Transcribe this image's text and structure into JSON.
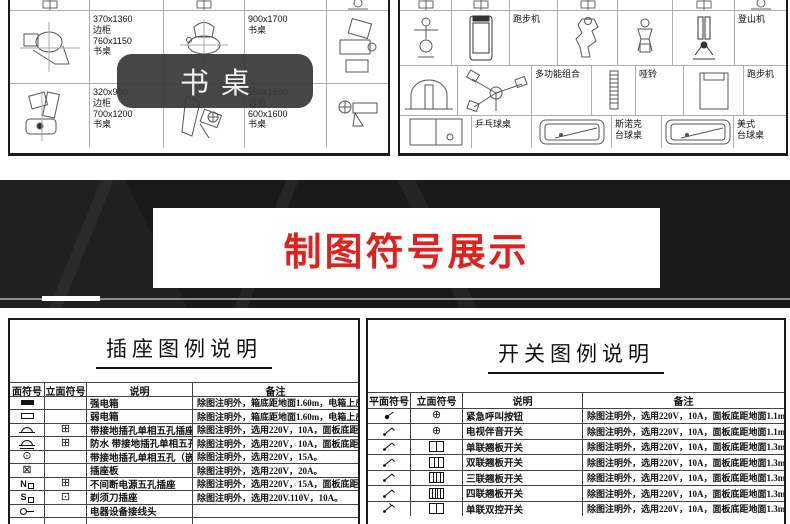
{
  "top_panels": {
    "overlay_label": "书桌",
    "left_panel": {
      "rows": [
        {
          "h": 13,
          "cells": [
            {
              "w": 80,
              "icon": "stub-line"
            },
            {
              "w": 74
            },
            {
              "w": 81,
              "icon": "stub-line"
            },
            {
              "w": 82
            },
            {
              "icon": "stub-chair"
            }
          ]
        },
        {
          "h": 73,
          "cells": [
            {
              "w": 80,
              "icon": "desk1"
            },
            {
              "w": 74,
              "label": "370x1360\n边柜\n760x1150\n书桌"
            },
            {
              "w": 81,
              "icon": "desk2"
            },
            {
              "w": 82,
              "label": "900x1700\n书桌"
            },
            {
              "icon": "desk3"
            }
          ]
        },
        {
          "h": 64,
          "cells": [
            {
              "w": 80,
              "icon": "desk4"
            },
            {
              "w": 74,
              "label": "320x900\n边柜\n700x1200\n书桌"
            },
            {
              "w": 81,
              "icon": "desk5"
            },
            {
              "w": 82,
              "label": "550x1500\n边柜\n600x1600\n书桌"
            },
            {
              "icon": "desk6"
            }
          ]
        }
      ]
    },
    "right_panel": {
      "rows": [
        {
          "h": 13,
          "cells": [
            {
              "w": 52,
              "icon": "stub-line"
            },
            {
              "w": 58,
              "icon": "stub-line"
            },
            {
              "w": 48
            },
            {
              "w": 60,
              "icon": "stub-line"
            },
            {
              "w": 55
            },
            {
              "w": 62,
              "icon": "stub-line"
            },
            {
              "icon": "stub-chair"
            }
          ]
        },
        {
          "h": 55,
          "cells": [
            {
              "w": 52,
              "icon": "figure"
            },
            {
              "w": 58,
              "icon": "treadmill"
            },
            {
              "w": 48,
              "label": "跑步机"
            },
            {
              "w": 60,
              "icon": "machine"
            },
            {
              "w": 55,
              "icon": "machine-sm"
            },
            {
              "w": 62,
              "icon": "climber"
            },
            {
              "label": "登山机"
            }
          ]
        },
        {
          "h": 50,
          "cells": [
            {
              "w": 58,
              "icon": "arch"
            },
            {
              "w": 74,
              "icon": "spinner"
            },
            {
              "w": 60,
              "label": "多功能组合"
            },
            {
              "w": 44,
              "icon": "ladder"
            },
            {
              "w": 48,
              "label": "哑铃"
            },
            {
              "w": 60,
              "icon": "rack"
            },
            {
              "label": "跑步机"
            }
          ]
        },
        {
          "h": 32,
          "cells": [
            {
              "w": 72,
              "icon": "pingpong"
            },
            {
              "w": 60,
              "label": "乒乓球桌"
            },
            {
              "w": 80,
              "icon": "billiard"
            },
            {
              "w": 50,
              "label": "斯诺克\n台球桌"
            },
            {
              "w": 72,
              "icon": "billiard"
            },
            {
              "label": "美式\n台球桌"
            }
          ]
        }
      ]
    }
  },
  "banner": {
    "title": "制图符号展示"
  },
  "legend_tables": {
    "socket": {
      "title": "插座图例说明",
      "headers": [
        "面符号",
        "立面符号",
        "说明",
        "备注"
      ],
      "rows": [
        {
          "plan": "strong-electric-box",
          "elev": "",
          "desc": "强电箱",
          "note": "除图注明外，箱底距地面1.60m，电箱上皮不高于2.0m。"
        },
        {
          "plan": "weak-electric-box",
          "elev": "",
          "desc": "弱电箱",
          "note": "除图注明外，箱底距地面1.60m，电箱上皮不高于2.0m。"
        },
        {
          "plan": "five-hole-socket",
          "elev": "socket-elevation",
          "desc": "带接地插孔单相五孔插座",
          "note": "除图注明外，选用220V，10A，面板底距地0.30m。"
        },
        {
          "plan": "five-hole-socket-waterproof",
          "elev": "socket-elevation",
          "desc": "防水 带接地插孔单相五孔插座",
          "note": "除图注明外，选用220V，10A，面板底距地0.30m。"
        },
        {
          "plan": "floor-socket",
          "elev": "",
          "desc": "带接地插孔单相五孔（嵌入地面）",
          "note": "除图注明外，选用220V，15A。"
        },
        {
          "plan": "socket-panel",
          "elev": "",
          "desc": "插座板",
          "note": "除图注明外，选用220V，20A。"
        },
        {
          "plan": "ups-n",
          "elev": "socket-elevation",
          "desc": "不间断电源五孔插座",
          "note": "除图注明外，选用220V，15A，面板底距地0.30m。"
        },
        {
          "plan": "shaver-s",
          "elev": "shaver-elevation",
          "desc": "剃须刀插座",
          "note": "除图注明外，选用220V.110V，10A。"
        },
        {
          "plan": "connector",
          "elev": "",
          "desc": "电器设备接线头",
          "note": ""
        },
        {
          "plan": "",
          "elev": "",
          "desc": "",
          "note": ""
        }
      ]
    },
    "switch": {
      "title": "开关图例说明",
      "headers": [
        "平面符号",
        "立面符号",
        "说明",
        "备注"
      ],
      "rows": [
        {
          "plan": "button-plan",
          "elev": "circle-cross",
          "desc": "紧急呼叫按钮",
          "note": "除图注明外，选用220V，10A，面板底距地面1.1m。"
        },
        {
          "plan": "switch-plan",
          "elev": "circle-cross",
          "desc": "电视伴音开关",
          "note": "除图注明外，选用220V，10A，面板底距地面1.1m。"
        },
        {
          "plan": "switch-plan",
          "elev": "rocker-1",
          "desc": "单联翘板开关",
          "note": "除图注明外，选用220V，10A，面板底距地面1.3m。"
        },
        {
          "plan": "switch-plan",
          "elev": "rocker-2",
          "desc": "双联翘板开关",
          "note": "除图注明外，选用220V，10A，面板底距地面1.3m。"
        },
        {
          "plan": "switch-plan",
          "elev": "rocker-3",
          "desc": "三联翘板开关",
          "note": "除图注明外，选用220V，10A，面板底距地面1.3m。"
        },
        {
          "plan": "switch-plan",
          "elev": "rocker-4",
          "desc": "四联翘板开关",
          "note": "除图注明外，选用220V，10A，面板底距地面1.3m。"
        },
        {
          "plan": "switch-plan-2",
          "elev": "rocker-1",
          "desc": "单联双控开关",
          "note": "除图注明外，选用220V，10A，面板底距地面1.3m。"
        }
      ]
    }
  }
}
